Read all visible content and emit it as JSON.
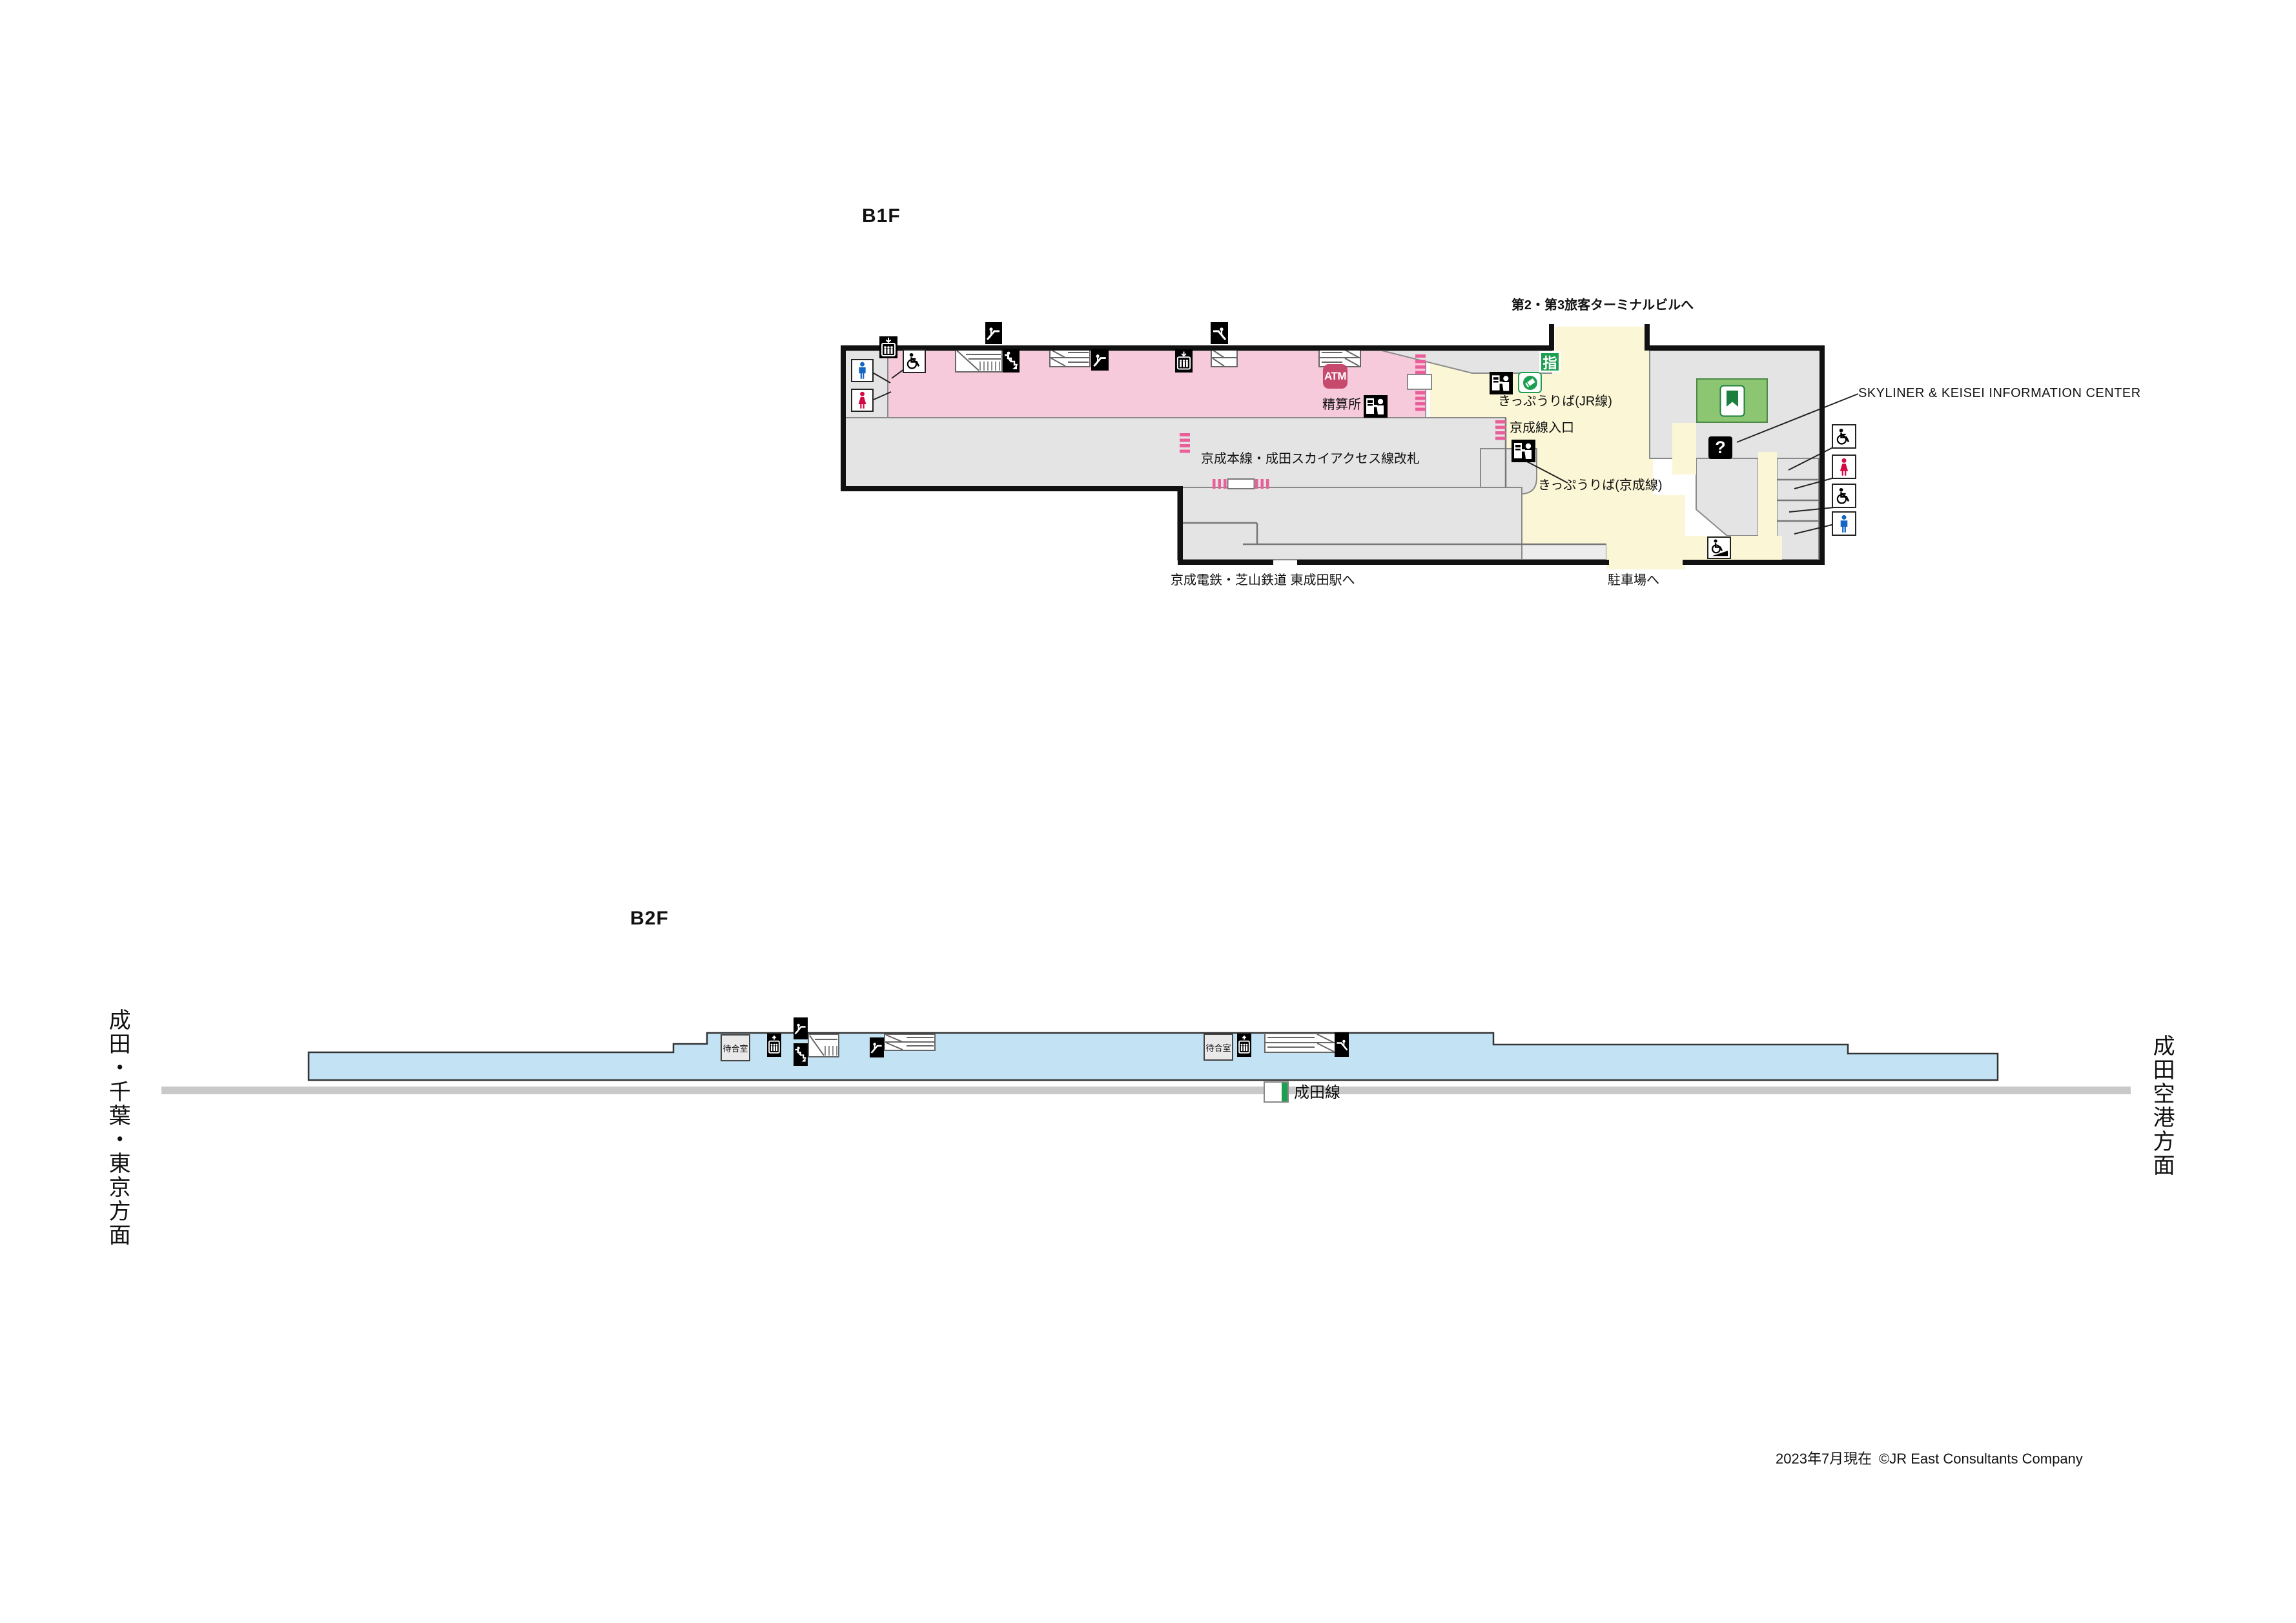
{
  "b1f": {
    "floor_label": "B1F",
    "to_terminal": "第2・第3旅客ターミナルビルへ",
    "tickets_jr": "きっぷうりば(JR線)",
    "reserved_badge": "指",
    "fare_adjustment": "精算所",
    "atm": "ATM",
    "keisei_entrance": "京成線入口",
    "tickets_keisei": "きっぷうりば(京成線)",
    "keisei_gates": "京成本線・成田スカイアクセス線改札",
    "info_center": "SKYLINER & KEISEI INFORMATION CENTER",
    "question_mark": "?",
    "to_higashi_narita": "京成電鉄・芝山鉄道 東成田駅へ",
    "to_parking": "駐車場へ"
  },
  "b2f": {
    "floor_label": "B2F",
    "waiting_room": "待合室",
    "line_badge": "成田線",
    "direction_left": "成田・千葉・東京方面",
    "direction_right": "成田空港方面"
  },
  "footer": {
    "as_of": "2023年7月現在",
    "copyright": "©JR East Consultants Company"
  },
  "colors": {
    "paid_area_pink": "#f7cadb",
    "corridor_yellow": "#fbf7d6",
    "platform_blue": "#c3e2f4",
    "room_gray": "#e4e4e4",
    "service_center_green": "#8cc673",
    "jr_green": "#1e9e51",
    "atm_crimson": "#c64a6d",
    "gate_pink": "#ea5f9a",
    "mens_blue": "#1565c4",
    "womens_red": "#d40a44",
    "track_gray": "#c9c9c9"
  }
}
